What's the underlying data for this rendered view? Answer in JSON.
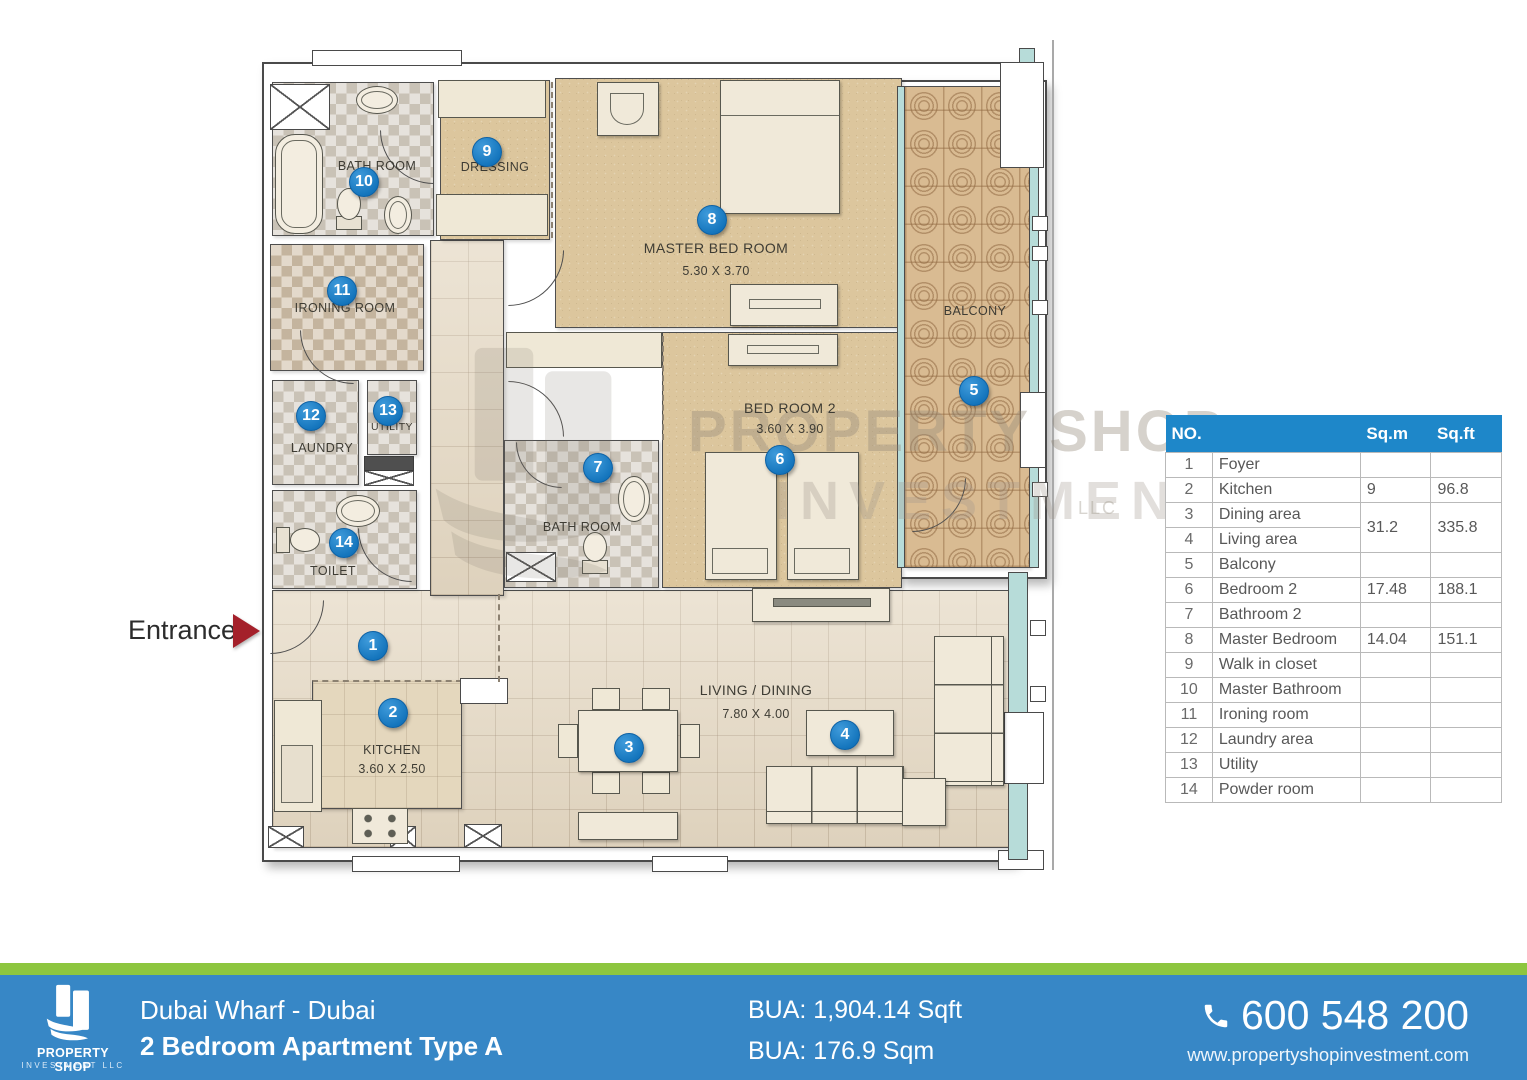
{
  "plan": {
    "entrance_label": "Entrance",
    "watermark": {
      "line1": "PROPERTY SHOP",
      "line2": "INVESTMENT",
      "line3": "LLC"
    },
    "rooms": [
      {
        "id": "master-bathroom",
        "label": "BATH ROOM",
        "marker": "10"
      },
      {
        "id": "dressing",
        "label": "DRESSING",
        "marker": "9"
      },
      {
        "id": "master-bedroom",
        "label": "MASTER BED ROOM",
        "dims": "5.30 X 3.70",
        "marker": "8"
      },
      {
        "id": "bedroom-2",
        "label": "BED ROOM 2",
        "dims": "3.60 X 3.90",
        "marker": "6"
      },
      {
        "id": "bathroom-2",
        "label": "BATH ROOM",
        "marker": "7"
      },
      {
        "id": "ironing-room",
        "label": "IRONING ROOM",
        "marker": "11"
      },
      {
        "id": "laundry",
        "label": "LAUNDRY",
        "marker": "12"
      },
      {
        "id": "utility",
        "label": "UTILITY",
        "marker": "13"
      },
      {
        "id": "toilet",
        "label": "TOILET",
        "marker": "14"
      },
      {
        "id": "foyer",
        "marker": "1"
      },
      {
        "id": "kitchen",
        "label": "KITCHEN",
        "dims": "3.60 X 2.50",
        "marker": "2"
      },
      {
        "id": "dining",
        "marker": "3"
      },
      {
        "id": "living-dining",
        "label": "LIVING / DINING",
        "dims": "7.80 X 4.00",
        "marker": "4"
      },
      {
        "id": "balcony",
        "label": "BALCONY",
        "marker": "5"
      }
    ]
  },
  "table": {
    "headers": {
      "no": "NO.",
      "sqm": "Sq.m",
      "sqft": "Sq.ft"
    },
    "rows": [
      {
        "no": "1",
        "name": "Foyer",
        "sqm": "",
        "sqft": ""
      },
      {
        "no": "2",
        "name": "Kitchen",
        "sqm": "9",
        "sqft": "96.8"
      },
      {
        "no": "3",
        "name": "Dining area",
        "sqm": "31.2",
        "sqft": "335.8"
      },
      {
        "no": "4",
        "name": "Living area"
      },
      {
        "no": "5",
        "name": "Balcony",
        "sqm": "",
        "sqft": ""
      },
      {
        "no": "6",
        "name": "Bedroom 2",
        "sqm": "17.48",
        "sqft": "188.1"
      },
      {
        "no": "7",
        "name": "Bathroom 2",
        "sqm": "",
        "sqft": ""
      },
      {
        "no": "8",
        "name": "Master Bedroom",
        "sqm": "14.04",
        "sqft": "151.1"
      },
      {
        "no": "9",
        "name": "Walk in closet",
        "sqm": "",
        "sqft": ""
      },
      {
        "no": "10",
        "name": "Master Bathroom",
        "sqm": "",
        "sqft": ""
      },
      {
        "no": "11",
        "name": "Ironing room",
        "sqm": "",
        "sqft": ""
      },
      {
        "no": "12",
        "name": "Laundry area",
        "sqm": "",
        "sqft": ""
      },
      {
        "no": "13",
        "name": "Utility",
        "sqm": "",
        "sqft": ""
      },
      {
        "no": "14",
        "name": "Powder room",
        "sqm": "",
        "sqft": ""
      }
    ]
  },
  "footer": {
    "logo": {
      "name": "PROPERTY SHOP",
      "sub": "INVESTMENT LLC"
    },
    "project": "Dubai Wharf  - Dubai",
    "unit": "2 Bedroom Apartment Type A",
    "bua_sqft": "BUA: 1,904.14 Sqft",
    "bua_sqm": "BUA: 176.9 Sqm",
    "phone": "600 548 200",
    "website": "www.propertyshopinvestment.com"
  },
  "colors": {
    "table_header_blue": "#1e87c9",
    "footer_blue": "#3787c6",
    "footer_green": "#8dc63f",
    "marker_blue": "#1d7fc6",
    "entrance_red": "#a4202a",
    "glass_teal": "#b7dcd9"
  }
}
